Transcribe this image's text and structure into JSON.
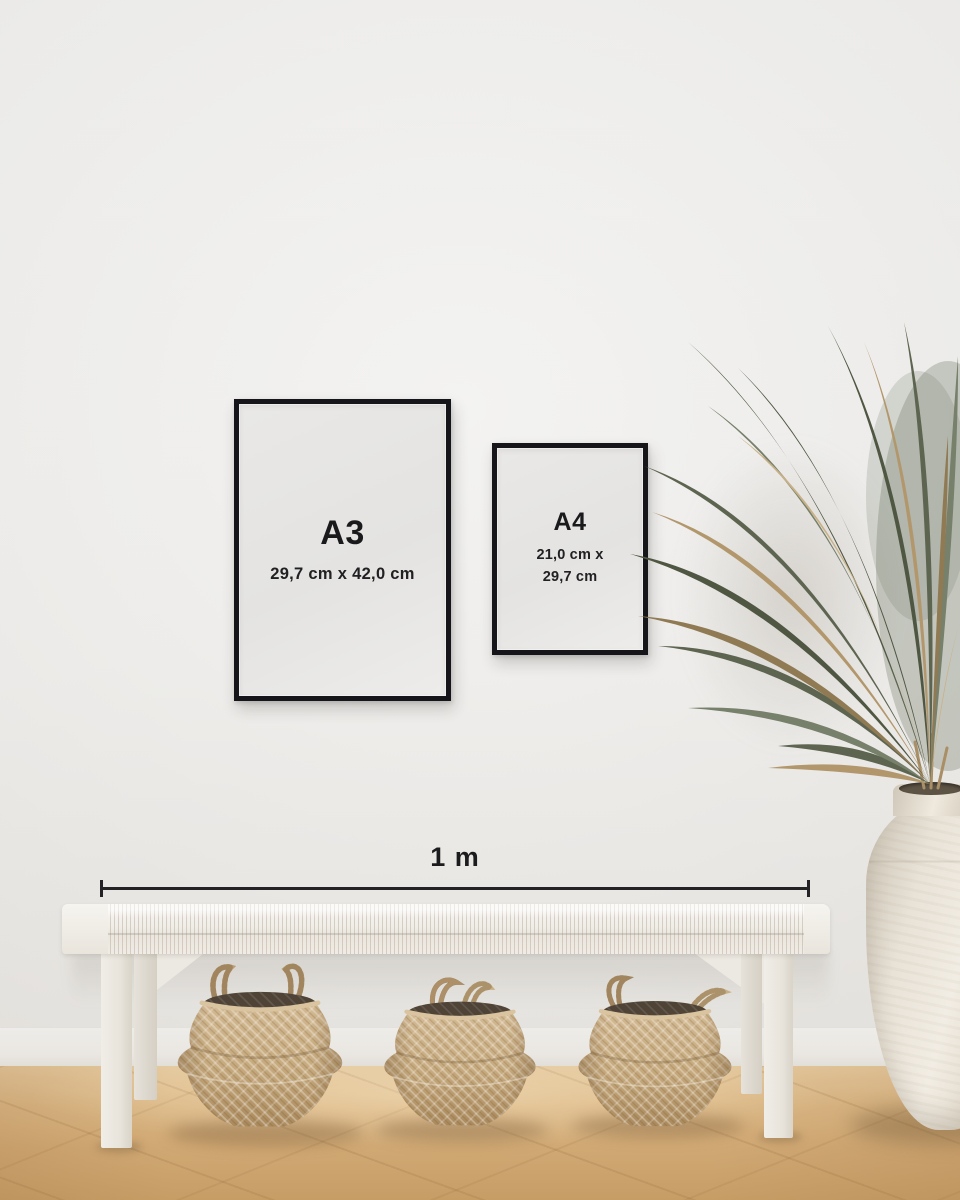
{
  "frames": {
    "a3": {
      "label": "A3",
      "dimensions": "29,7 cm x 42,0 cm"
    },
    "a4": {
      "label": "A4",
      "dimensions_line1": "21,0 cm x",
      "dimensions_line2": "29,7 cm"
    }
  },
  "scale": {
    "label": "1 m"
  },
  "palette": {
    "wall": "#f0efee",
    "frame-border": "#16161a",
    "frame-paper": "#e7e6e4",
    "text": "#1a1a1c",
    "baseboard": "#ebe8e4",
    "floor-light": "#e4c89d",
    "floor-dark": "#c79d66",
    "bench": "#f1eee8",
    "basket-light": "#d2b992",
    "basket-dark": "#aa8a5d",
    "basket-interior": "#4e4336",
    "plant-green": "#5d6551",
    "plant-tan": "#b2976c",
    "vase": "#efeae2"
  }
}
